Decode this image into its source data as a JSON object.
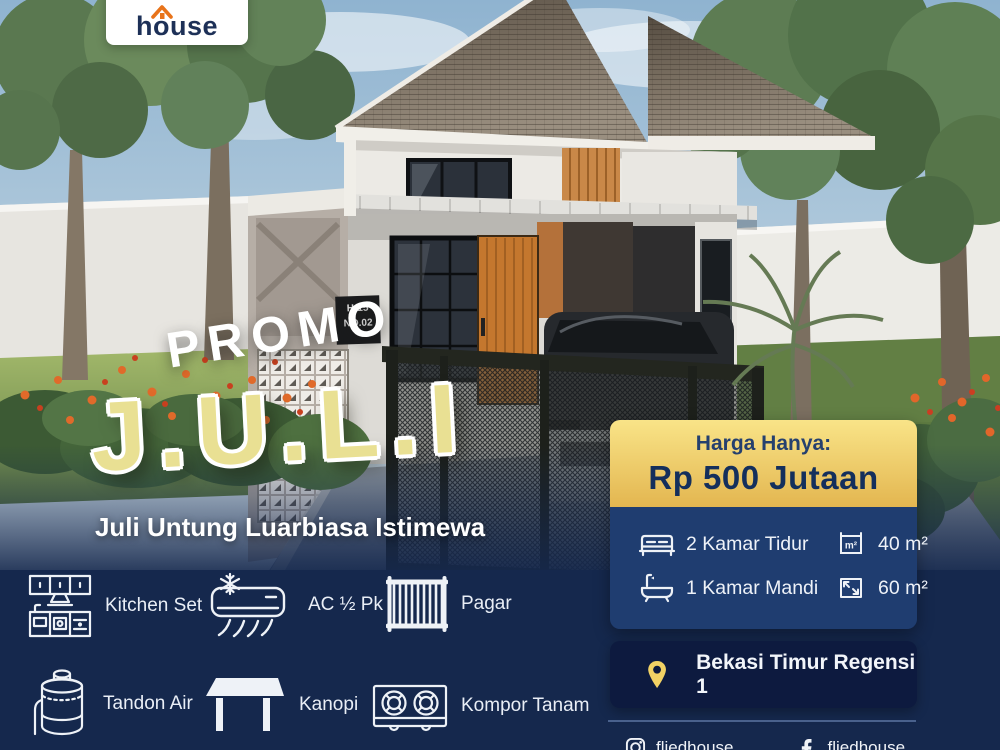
{
  "brand": {
    "logo_text": "house"
  },
  "hero": {
    "promo_kicker": "PROMO",
    "promo_title": "J.U.L.I",
    "tagline": "Juli Untung Luarbiasa Istimewa",
    "house_plate_line1": "H-15",
    "house_plate_line2": "NO.02"
  },
  "price_card": {
    "label": "Harga Hanya:",
    "value": "Rp 500 Jutaan"
  },
  "specs": [
    {
      "icon": "bed-icon",
      "label": "2 Kamar Tidur"
    },
    {
      "icon": "bathtub-icon",
      "label": "1 Kamar Mandi"
    },
    {
      "icon": "building-area-icon",
      "label": "40 m²"
    },
    {
      "icon": "land-area-icon",
      "label": "60 m²"
    }
  ],
  "location": {
    "icon": "location-pin-icon",
    "label": "Bekasi Timur Regensi 1"
  },
  "amenities": [
    {
      "icon": "kitchen-set-icon",
      "label": "Kitchen Set"
    },
    {
      "icon": "ac-icon",
      "label": "AC ½ Pk"
    },
    {
      "icon": "fence-icon",
      "label": "Pagar"
    },
    {
      "icon": "water-tank-icon",
      "label": "Tandon Air"
    },
    {
      "icon": "canopy-icon",
      "label": "Kanopi"
    },
    {
      "icon": "stove-icon",
      "label": "Kompor Tanam"
    }
  ],
  "social": [
    {
      "icon": "instagram-icon",
      "handle": "fliedhouse"
    },
    {
      "icon": "facebook-icon",
      "handle": "fliedhouse"
    }
  ],
  "colors": {
    "navy": "#15284d",
    "panel_navy": "#1f3d70",
    "deep_navy": "#0d1a3f",
    "gold_light": "#f9e488",
    "gold": "#e3b650",
    "promo_yellow": "#e9e093",
    "accent_orange": "#e8731a",
    "text_navy": "#142f5c"
  }
}
